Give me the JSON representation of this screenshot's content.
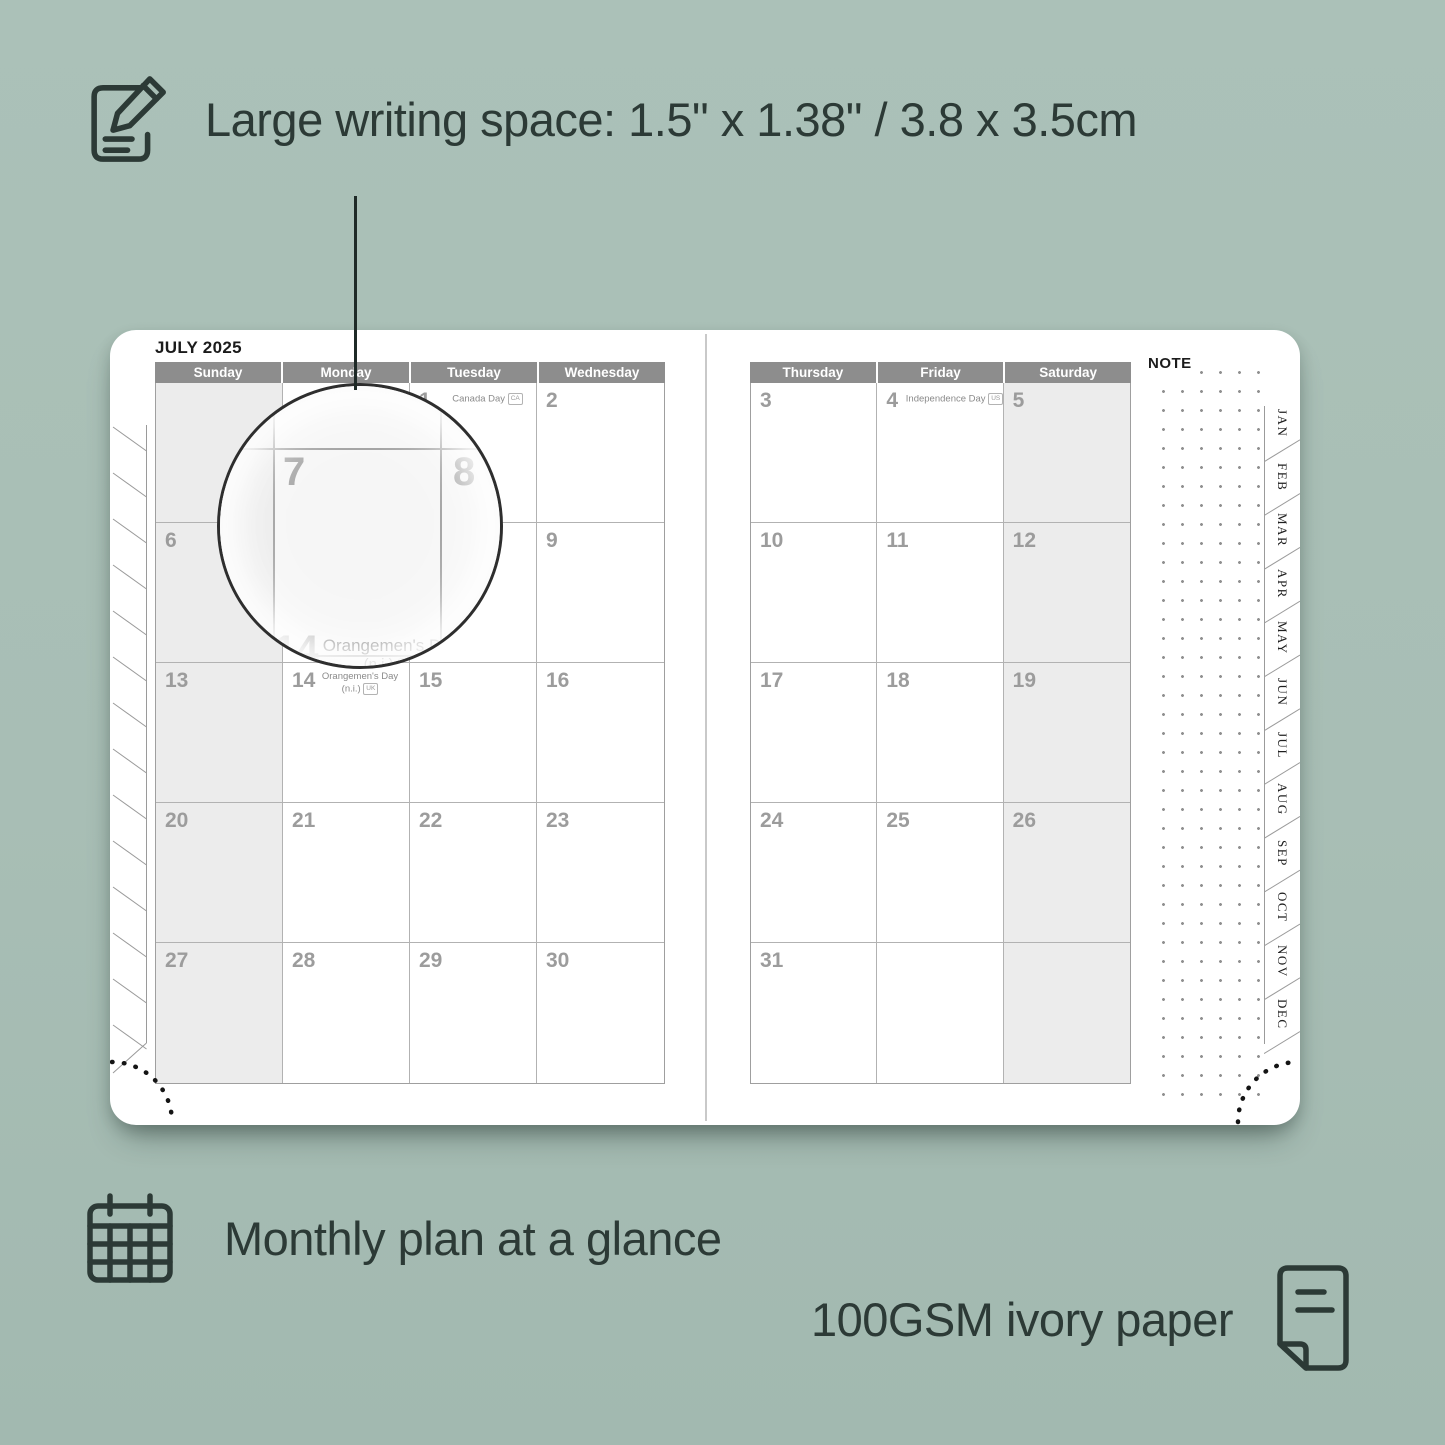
{
  "colors": {
    "background": "#a8beb5",
    "ink": "#2c3a36",
    "header_bg": "#8d8d8d",
    "header_text": "#ffffff",
    "grid_line": "#b2b2b2",
    "day_number": "#9c9c9c",
    "weekend_fill": "#ececec",
    "page": "#ffffff"
  },
  "features": {
    "writing_space": {
      "icon": "notepad-pencil-icon",
      "label": "Large writing space: 1.5\" x 1.38\" / 3.8 x 3.5cm"
    },
    "monthly_plan": {
      "icon": "calendar-grid-icon",
      "label": "Monthly plan at a glance"
    },
    "paper": {
      "icon": "paper-sheet-icon",
      "label": "100GSM ivory paper"
    }
  },
  "planner": {
    "month_title": "JULY 2025",
    "note_label": "NOTE",
    "left_page": {
      "day_headers": [
        "Sunday",
        "Monday",
        "Tuesday",
        "Wednesday"
      ],
      "shaded_col": 0,
      "rows": [
        [
          {
            "day": ""
          },
          {
            "day": ""
          },
          {
            "day": "1",
            "holiday": {
              "line1": "Canada Day",
              "badge": "CA",
              "layout": "inline"
            }
          },
          {
            "day": "2"
          }
        ],
        [
          {
            "day": "6"
          },
          {
            "day": "7"
          },
          {
            "day": "8"
          },
          {
            "day": "9"
          }
        ],
        [
          {
            "day": "13"
          },
          {
            "day": "14",
            "holiday": {
              "line1": "Orangemen's Day",
              "line2": "(n.i.)",
              "badge": "UK",
              "layout": "stack"
            }
          },
          {
            "day": "15"
          },
          {
            "day": "16"
          }
        ],
        [
          {
            "day": "20"
          },
          {
            "day": "21"
          },
          {
            "day": "22"
          },
          {
            "day": "23"
          }
        ],
        [
          {
            "day": "27"
          },
          {
            "day": "28"
          },
          {
            "day": "29"
          },
          {
            "day": "30"
          }
        ]
      ]
    },
    "right_page": {
      "day_headers": [
        "Thursday",
        "Friday",
        "Saturday"
      ],
      "shaded_col": 2,
      "rows": [
        [
          {
            "day": "3"
          },
          {
            "day": "4",
            "holiday": {
              "line1": "Independence Day",
              "badge": "US",
              "layout": "inline"
            }
          },
          {
            "day": "5"
          }
        ],
        [
          {
            "day": "10"
          },
          {
            "day": "11"
          },
          {
            "day": "12"
          }
        ],
        [
          {
            "day": "17"
          },
          {
            "day": "18"
          },
          {
            "day": "19"
          }
        ],
        [
          {
            "day": "24"
          },
          {
            "day": "25"
          },
          {
            "day": "26"
          }
        ],
        [
          {
            "day": "31"
          },
          {
            "day": ""
          },
          {
            "day": ""
          }
        ]
      ]
    },
    "month_tabs": [
      "JAN",
      "FEB",
      "MAR",
      "APR",
      "MAY",
      "JUN",
      "JUL",
      "AUG",
      "SEP",
      "OCT",
      "NOV",
      "DEC"
    ],
    "magnifier": {
      "day_main": "7",
      "day_next": "8",
      "day_below": "14",
      "holiday_line1": "Orangemen's Day",
      "holiday_line2": "(n.i.)",
      "holiday_badge": "UK"
    }
  }
}
